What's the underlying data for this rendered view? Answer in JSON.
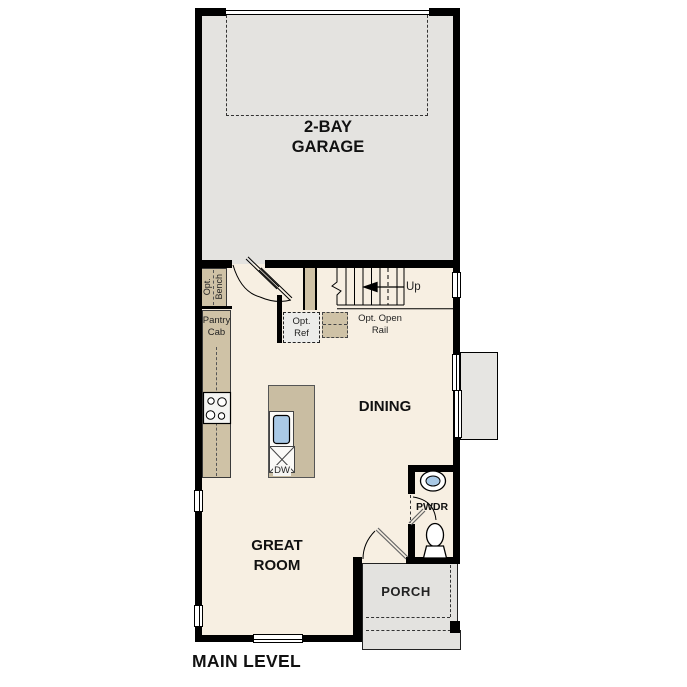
{
  "page": {
    "title": "MAIN LEVEL"
  },
  "rooms": {
    "garage": "2-BAY\nGARAGE",
    "dining": "DINING",
    "great_room": "GREAT\nROOM",
    "porch": "PORCH",
    "powder": "PWDR"
  },
  "annotations": {
    "up": "Up",
    "opt_bench": "Opt.\nBench",
    "pantry_cab": "Pantry\nCab",
    "opt_ref": "Opt.\nRef",
    "opt_open_rail": "Opt. Open\nRail",
    "dishwasher": "DW"
  },
  "colors": {
    "wall": "#000000",
    "garage_floor": "#e4e3e0",
    "main_floor": "#f7efe2",
    "cabinet": "#cfc2a6",
    "island": "#c9bda2",
    "porch_floor": "#e3e2df",
    "fixture_blue": "#a9c9e6"
  }
}
